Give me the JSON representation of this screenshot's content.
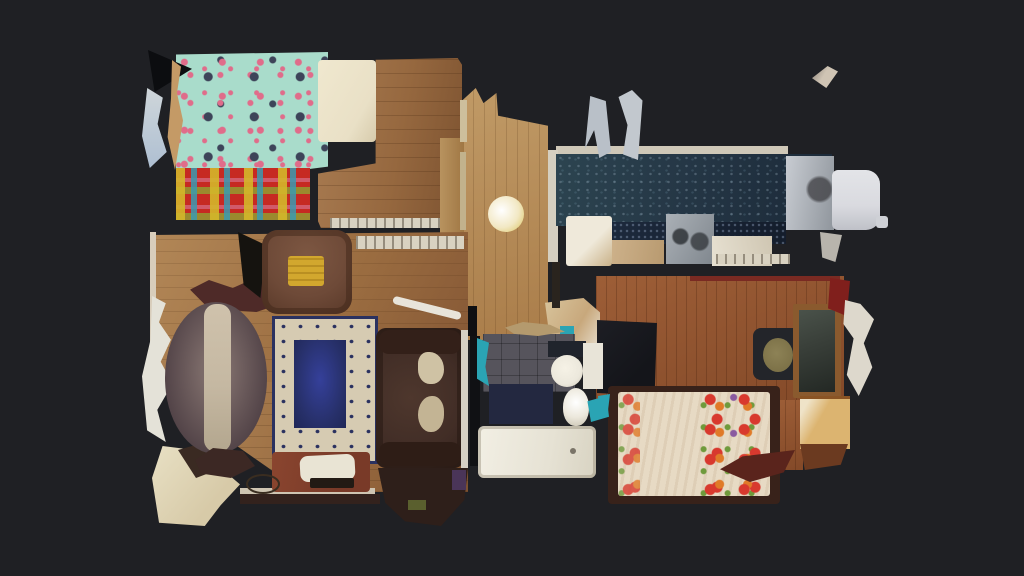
{
  "scene": {
    "type": "3d-dollhouse-floorplan-top-view",
    "background_note": "dark viewer canvas, no visible text or UI controls",
    "rooms": [
      {
        "name": "bedroom-1",
        "position": "top-left",
        "objects": [
          "mint-floral-bed",
          "cream-pillow",
          "red-plaid-blanket",
          "wood-floor",
          "curtain-fragments"
        ]
      },
      {
        "name": "living-room",
        "position": "left-center",
        "objects": [
          "oval-dining-table",
          "table-runner",
          "dining-chairs",
          "leather-recliner",
          "yellow-towel",
          "area-rug-navy-center",
          "leather-loveseat",
          "cream-sofa-pillows",
          "tv-stand",
          "cable-loop",
          "window-sill",
          "cream-floor-mat",
          "curtain-fragments"
        ]
      },
      {
        "name": "hallway",
        "position": "center",
        "objects": [
          "wood-floor",
          "round-light-fixture"
        ]
      },
      {
        "name": "kitchen",
        "position": "top-right",
        "objects": [
          "dark-teal-floor",
          "navy-speckled-counter",
          "white-cabinet",
          "tan-counter",
          "dishwasher",
          "white-counter",
          "stainless-stove",
          "white-washing-machine",
          "gray-chair-backs"
        ]
      },
      {
        "name": "bathroom",
        "position": "bottom-center",
        "objects": [
          "gray-tile-floor",
          "navy-bath-mat",
          "toilet",
          "pedestal-sink",
          "white-cabinet",
          "bathtub",
          "teal-towels"
        ]
      },
      {
        "name": "bedroom-2",
        "position": "right",
        "objects": [
          "red-floral-bed",
          "dark-bed-frame",
          "wardrobe-dark",
          "office-chair",
          "dresser-with-mirror",
          "tan-nightstand",
          "red-fabric",
          "scan-fragments"
        ]
      }
    ],
    "artifacts": [
      "floating-mesh-shard-top-right"
    ]
  },
  "palette": {
    "bg": "#1f2024",
    "wood_b1": "#96683f",
    "wood_liv": "#9a6c40",
    "wood_hall": "#aa7d4a",
    "wood_b2": "#834928",
    "bed1_base": "#a9dccb",
    "bed1_flower": "#e06c8a",
    "bed1_navy": "#3d4459",
    "pillow_cream": "#e9e0c6",
    "plaid_red": "#c62a22",
    "armchair_brown": "#6e4a38",
    "towel_yellow": "#d2a72e",
    "table_dark": "#544549",
    "table_runner": "#c5b8a2",
    "rug_border": "#d6cbb2",
    "rug_navy": "#2a3160",
    "sofa_brown": "#412d26",
    "sofa_pillow": "#cfc2a4",
    "kitchen_teal": "#253746",
    "kitchen_navy": "#1d2a3d",
    "counter_cream": "#d9d2c1",
    "steel_gray": "#9aa0a6",
    "appliance_white": "#d9dadf",
    "bath_floor": "#56545c",
    "bath_mat_navy": "#232840",
    "fixture_white": "#ece8dc",
    "towel_teal": "#2aa4b4",
    "duvet_cream": "#e7dac4",
    "floral_red": "#d8392e",
    "bed2_frame": "#38221a",
    "mirror_green": "#3a403a",
    "dresser_brown": "#8a5a2e",
    "nightstand_tan": "#dcb470",
    "fragment_light": "#ddd8cc",
    "tvstand_red": "#793a28",
    "chair_seat_olive": "#7d7248",
    "dark_red": "#801f1c",
    "curtain_white": "#e4e2d8"
  }
}
